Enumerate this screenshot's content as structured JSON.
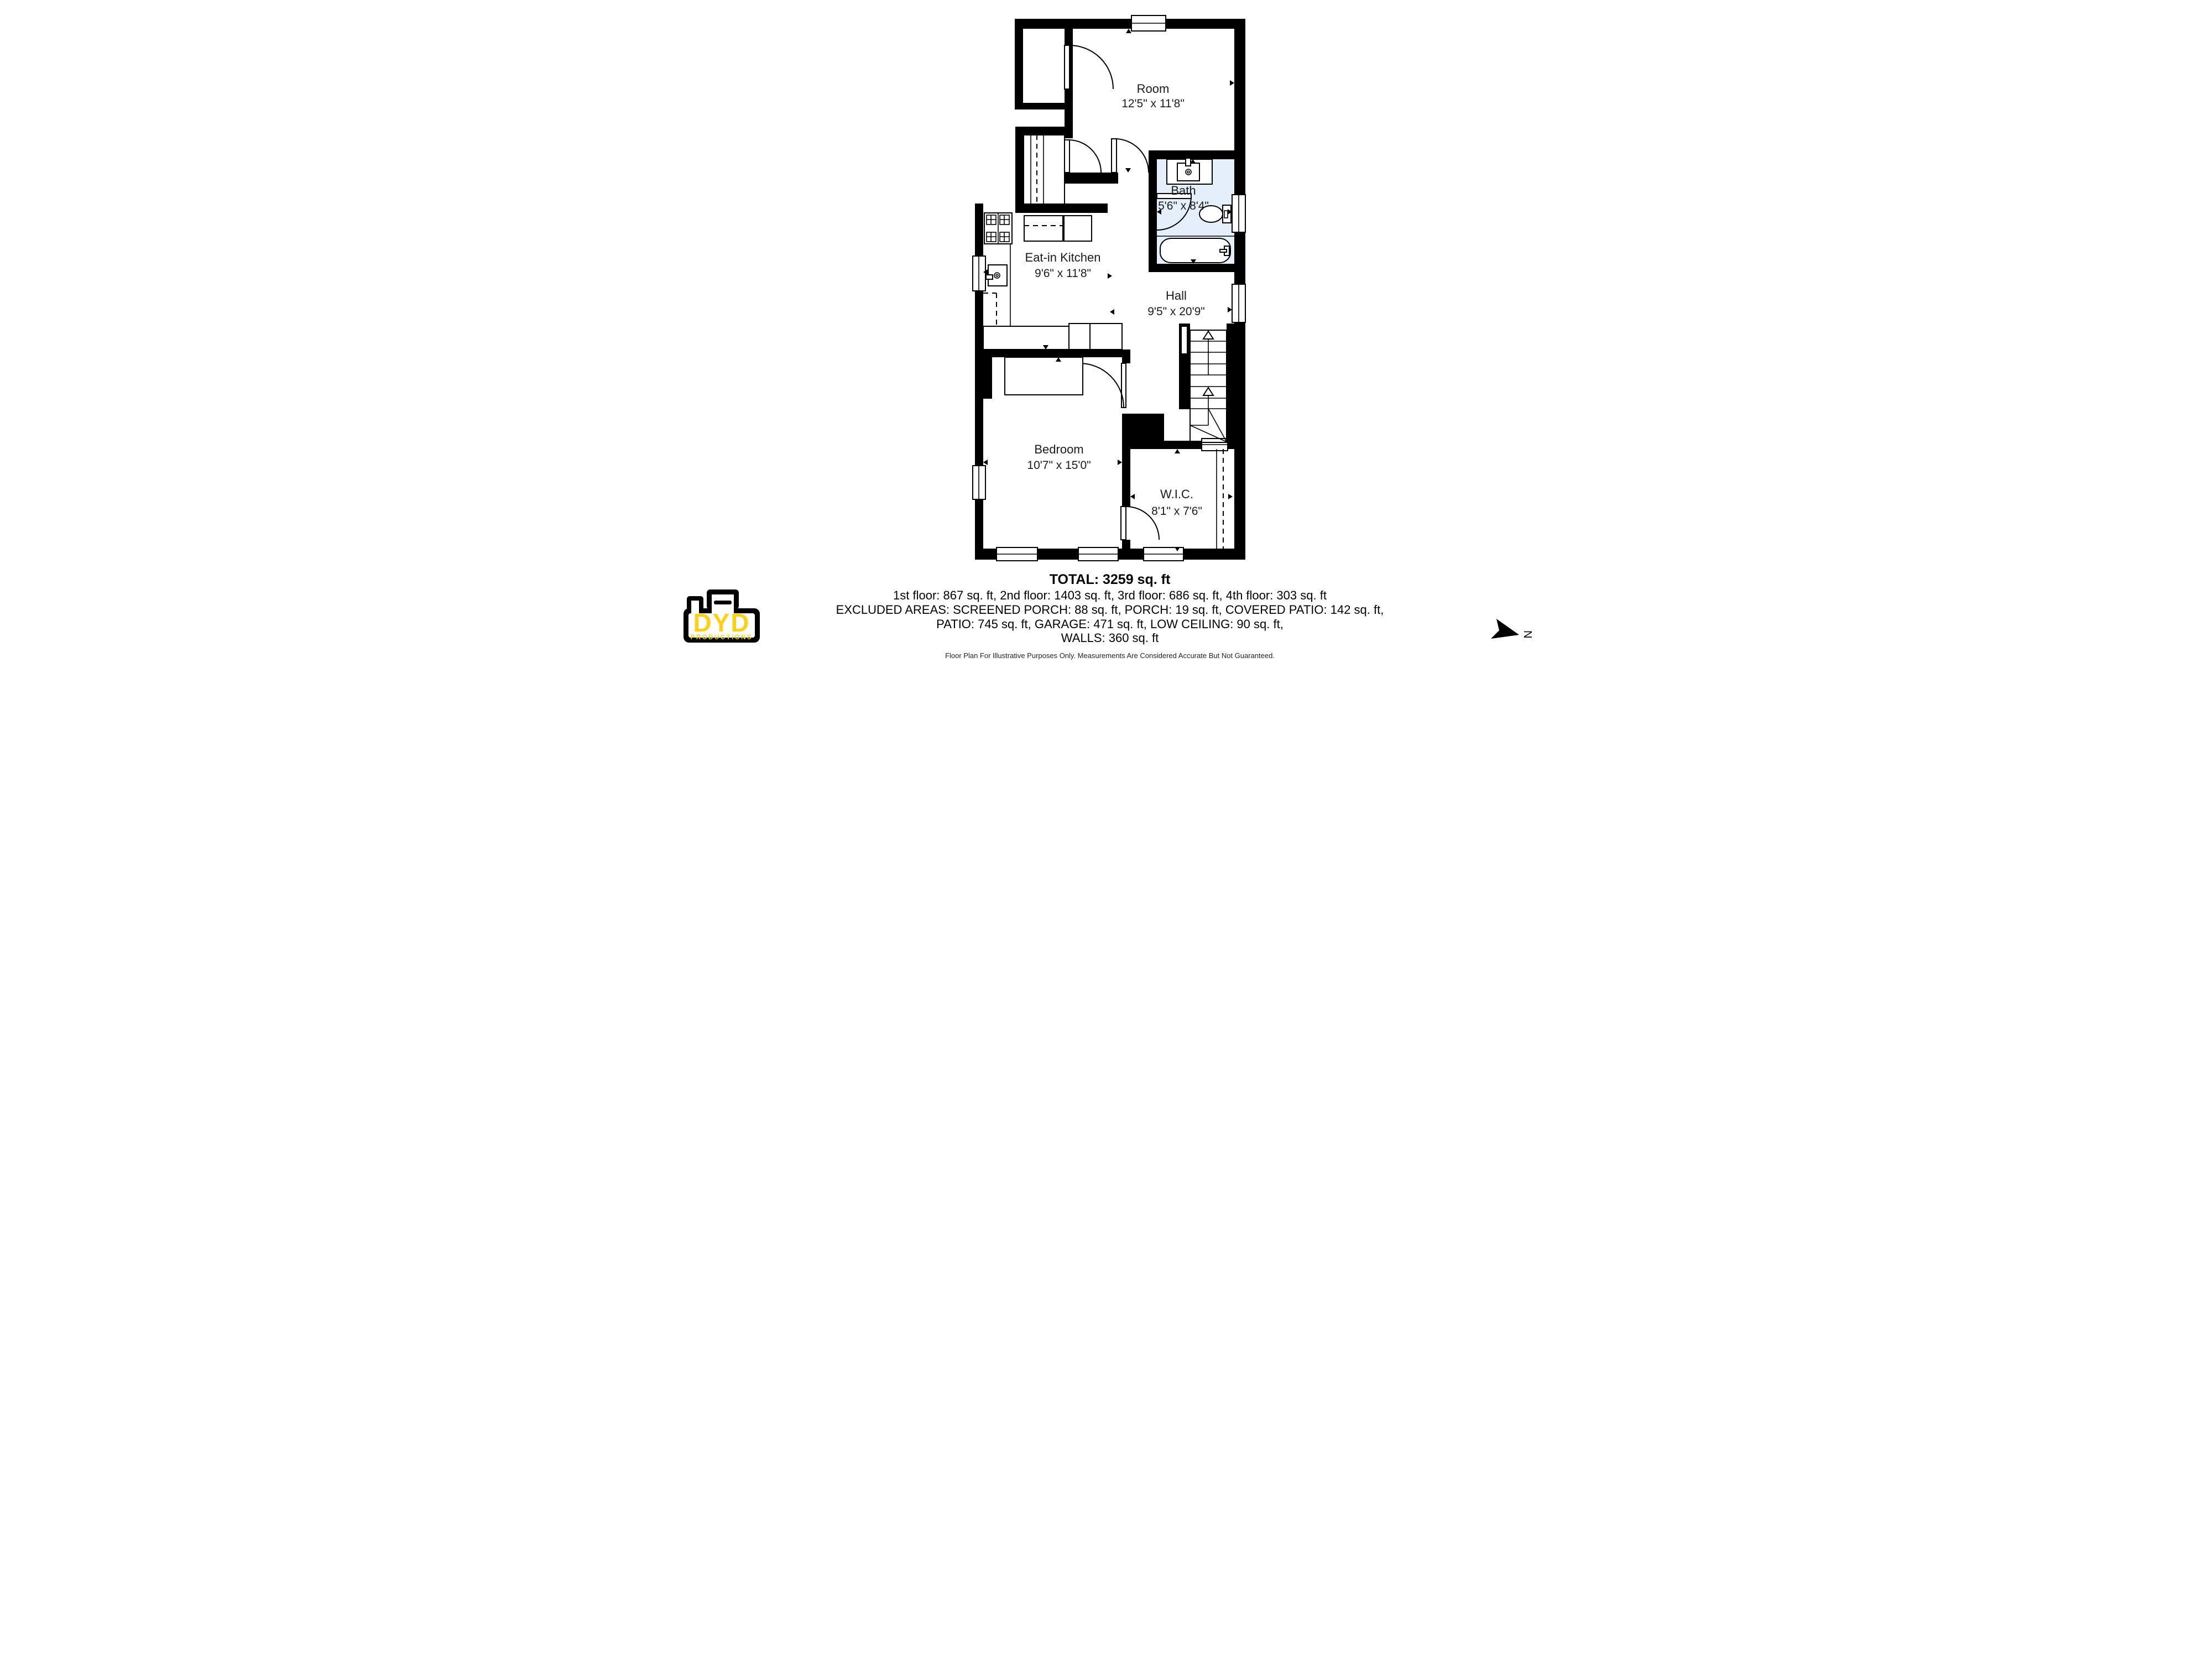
{
  "rooms": [
    {
      "name": "Room",
      "dims": "12'5\" x 11'8\""
    },
    {
      "name": "Bath",
      "dims": "5'6\" x 8'4\""
    },
    {
      "name": "Eat-in Kitchen",
      "dims": "9'6\" x 11'8\""
    },
    {
      "name": "Hall",
      "dims": "9'5\" x 20'9\""
    },
    {
      "name": "Bedroom",
      "dims": "10'7\" x 15'0\""
    },
    {
      "name": "W.I.C.",
      "dims": "8'1\" x 7'6\""
    }
  ],
  "summary": {
    "total": "TOTAL: 3259 sq. ft",
    "floors": "1st floor: 867 sq. ft, 2nd floor: 1403 sq. ft, 3rd floor: 686 sq. ft, 4th floor: 303 sq. ft",
    "excluded1": "EXCLUDED AREAS: SCREENED PORCH: 88 sq. ft, PORCH: 19 sq. ft, COVERED PATIO: 142 sq. ft,",
    "excluded2": "PATIO: 745 sq. ft, GARAGE: 471 sq. ft, LOW CEILING: 90 sq. ft,",
    "walls": "WALLS: 360 sq. ft",
    "disclaimer": "Floor Plan For Illustrative Purposes Only. Measurements Are Considered Accurate But Not Guaranteed."
  },
  "logo": {
    "name": "DYD",
    "subtitle": "PRODUCTIONS"
  },
  "compass": {
    "label": "N"
  },
  "colors": {
    "bath_fill": "#E4EFFB",
    "wall": "#000000",
    "logo_yellow": "#FFD01B"
  }
}
